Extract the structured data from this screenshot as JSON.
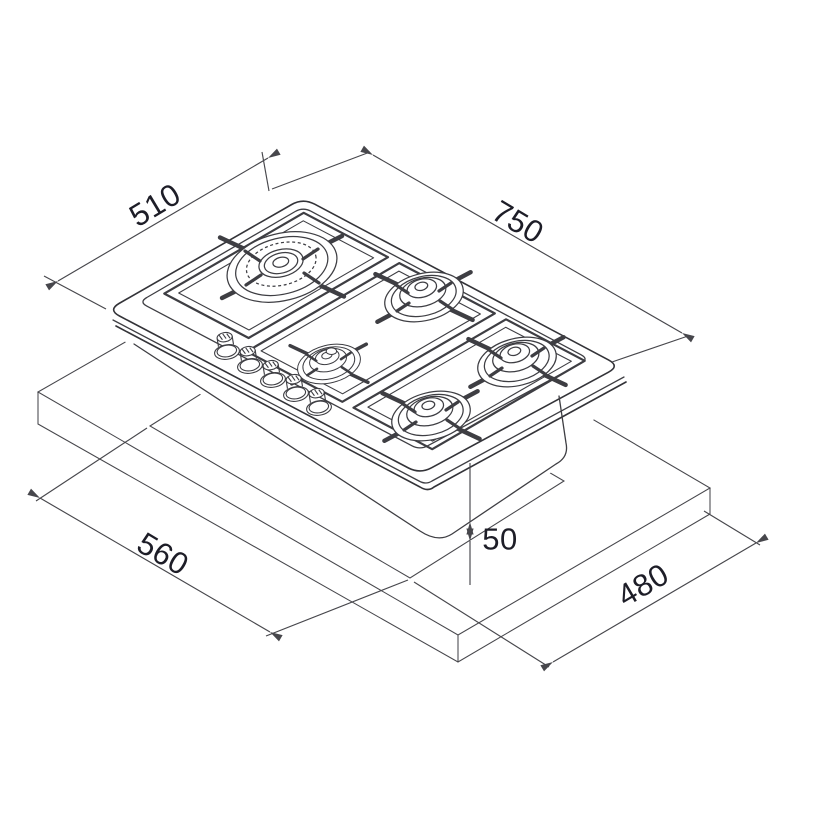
{
  "diagram": {
    "type": "installation-drawing",
    "subject": "5-burner gas hob with worktop cut-out",
    "background_color": "#ffffff",
    "line_color": "#3e3e43",
    "text_color": "#1d1d27",
    "dimensions": {
      "hob_depth": {
        "label": "510"
      },
      "hob_width": {
        "label": "750"
      },
      "cutout_width": {
        "label": "560"
      },
      "cutout_depth": {
        "label": "480"
      },
      "rear_clearance": {
        "label": "50"
      }
    }
  }
}
